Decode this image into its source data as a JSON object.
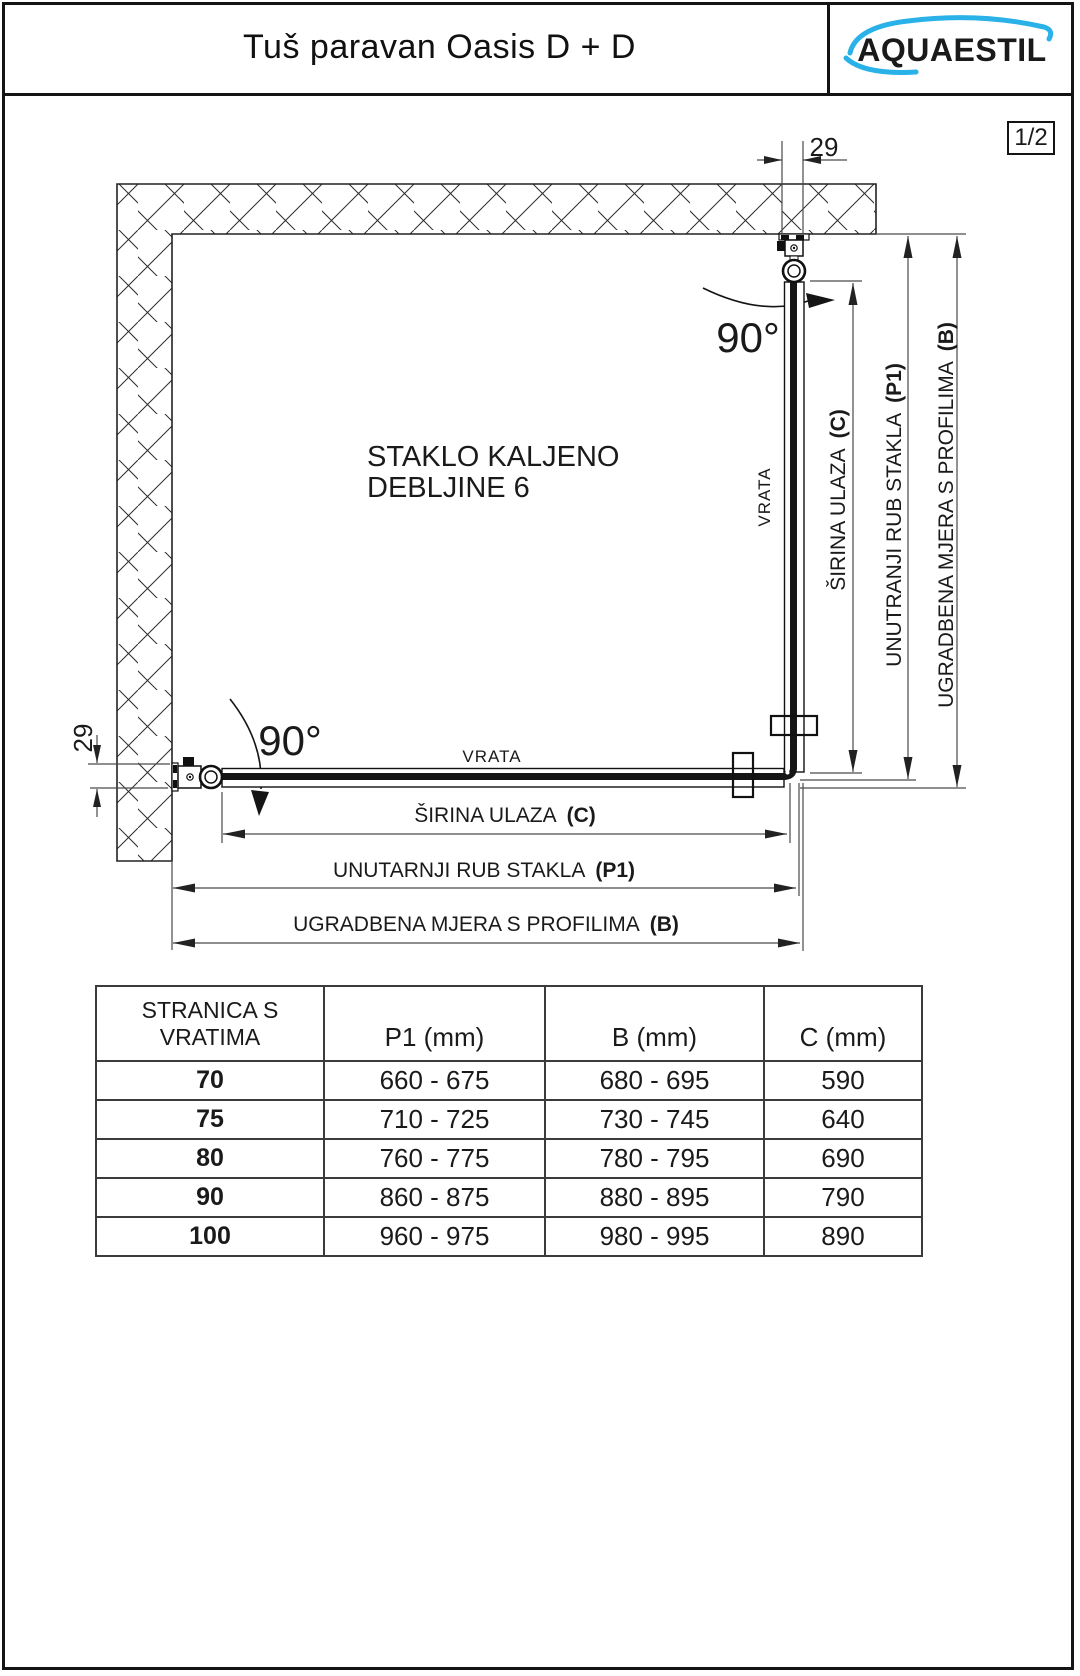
{
  "header": {
    "title": "Tuš paravan Oasis D + D",
    "logo": "AQUAESTIL",
    "page_number": "1/2"
  },
  "drawing": {
    "glass_note": {
      "line1": "STAKLO KALJENO",
      "line2": "DEBLJINE 6"
    },
    "angles": {
      "top": "90°",
      "bottom": "90°"
    },
    "offsets": {
      "top": "29",
      "left": "29"
    },
    "door_labels": {
      "vertical": "VRATA",
      "horizontal": "VRATA"
    },
    "dims_right": {
      "entry_width": {
        "label": "ŠIRINA ULAZA",
        "code": "(C)"
      },
      "glass_edge": {
        "label": "UNUTRANJI RUB STAKLA",
        "code": "(P1)"
      },
      "profile": {
        "label": "UGRADBENA MJERA S PROFILIMA",
        "code": "(B)"
      }
    },
    "dims_bottom": {
      "entry_width": {
        "label": "ŠIRINA ULAZA",
        "code": "(C)"
      },
      "glass_edge": {
        "label": "UNUTARNJI RUB STAKLA",
        "code": "(P1)"
      },
      "profile": {
        "label": "UGRADBENA MJERA S PROFILIMA",
        "code": "(B)"
      }
    }
  },
  "table": {
    "headers": {
      "col1_line1": "STRANICA S",
      "col1_line2": "VRATIMA",
      "col2": "P1 (mm)",
      "col3": "B (mm)",
      "col4": "C (mm)"
    },
    "rows": [
      {
        "size": "70",
        "p1": "660 - 675",
        "b": "680 - 695",
        "c": "590"
      },
      {
        "size": "75",
        "p1": "710 - 725",
        "b": "730 - 745",
        "c": "640"
      },
      {
        "size": "80",
        "p1": "760 - 775",
        "b": "780 - 795",
        "c": "690"
      },
      {
        "size": "90",
        "p1": "860 - 875",
        "b": "880 - 895",
        "c": "790"
      },
      {
        "size": "100",
        "p1": "960 - 975",
        "b": "980 - 995",
        "c": "890"
      }
    ]
  },
  "colors": {
    "logo_navy": "#1c2e8c",
    "logo_cyan": "#2ab2e8",
    "ink": "#151515"
  }
}
